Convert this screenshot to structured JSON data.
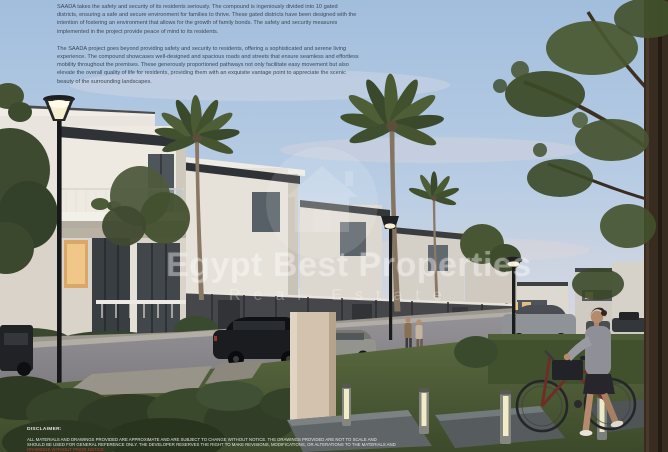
{
  "intro": {
    "p1": "SAADA takes the safety and security of its residents seriously. The compound is ingeniously divided into 10 gated districts, ensuring a safe and secure environment for families to thrive. These gated districts have been designed with the intention of fostering an environment that allows for the growth of family bonds. The safety and security measures implemented in the project provide peace of mind to its residents.",
    "p2": "The SAADA project goes beyond providing safety and security to residents, offering a sophisticated and serene living experience. The compound showcases well-designed and spacious roads and streets that ensure seamless and effortless mobility throughout the premises. These generously proportioned pathways not only facilitate easy movement but also elevate the overall quality of life for residents, providing them with an exquisite vantage point to appreciate the scenic beauty of the surrounding landscapes."
  },
  "watermark": {
    "brand": "Egypt Best Properties",
    "tagline": "Real Estate",
    "logo_icon": "house-circle-icon"
  },
  "disclaimer": {
    "label": "DISCLAIMER:",
    "line1": "ALL MATERIALS AND DRAWINGS PROVIDED ARE APPROXIMATE AND ARE SUBJECT TO CHANGE WITHOUT NOTICE. THE DRAWINGS PROVIDED ARE NOT TO SCALE AND",
    "line2": "SHOULD BE USED FOR GENERAL REFERENCE ONLY. THE DEVELOPER RESERVES THE RIGHT TO MAKE REVISIONS, MODIFICATIONS, OR ALTERATIONS TO THE MATERIALS AND",
    "line3": "DRAWINGS WITHOUT PRIOR NOTICE."
  },
  "colors": {
    "sky_top": "#a9c3df",
    "body_text": "#3e4854",
    "watermark_white": "#ffffff",
    "disclaimer_red": "#c23b2e",
    "lamp_glow": "#f6efd2",
    "window_glow": "#e9b96e",
    "lawn_green": "#4c5a34"
  }
}
